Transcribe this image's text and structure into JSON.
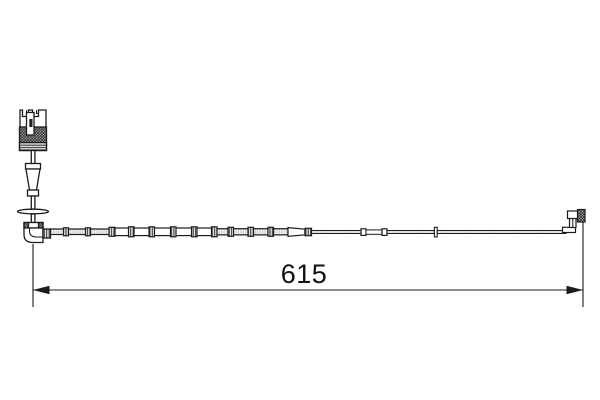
{
  "diagram": {
    "dimension": {
      "label": "615"
    },
    "colors": {
      "line": "#1c1c1c",
      "background": "#ffffff",
      "hatch_fill": "#b8b8b8",
      "clip_fill": "#ececec",
      "wire_texture": "#9a9a9a"
    }
  }
}
